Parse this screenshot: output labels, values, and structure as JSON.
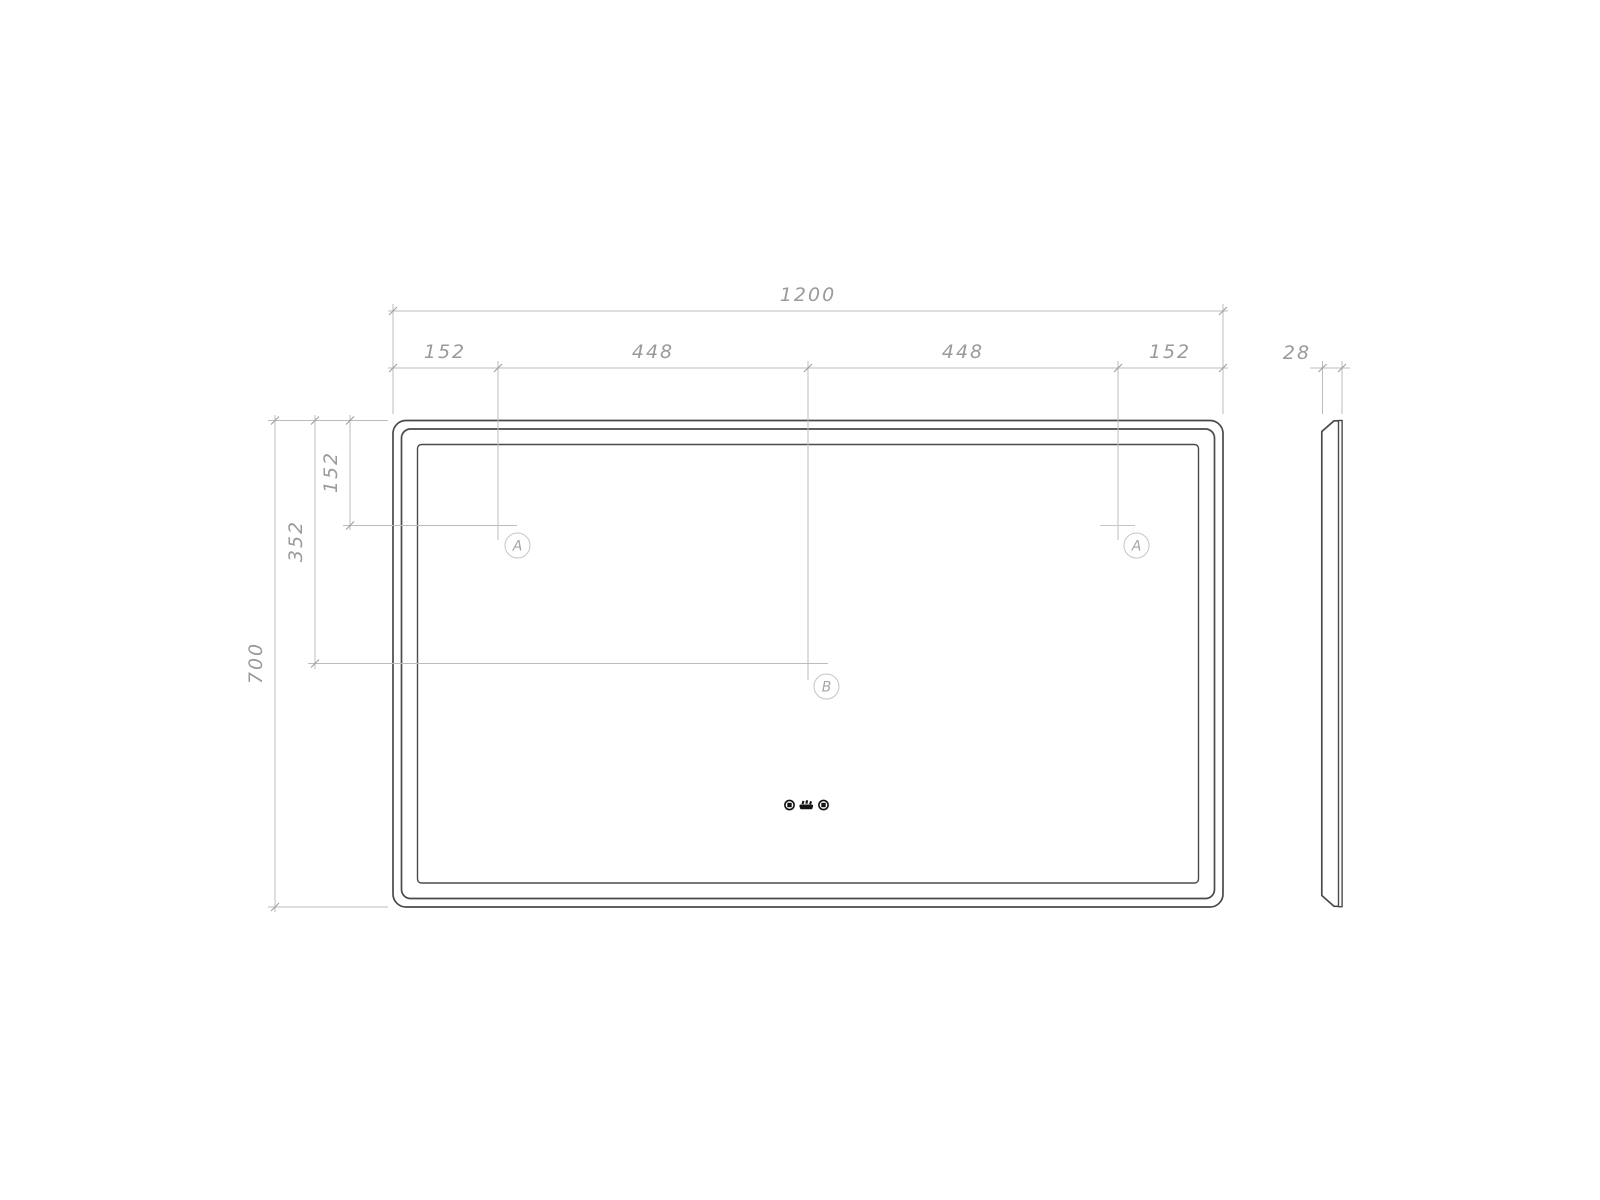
{
  "drawing": {
    "type": "technical-dimension-drawing",
    "subject": "rectangular LED mirror, front view and side profile",
    "colors": {
      "background": "#ffffff",
      "object_line": "#4a4a4a",
      "dimension_line": "#bcbcbc",
      "dimension_text": "#9a9a9a",
      "icon": "#141414"
    },
    "dimensions": {
      "top_total": "1200",
      "seg_left_margin": "152",
      "seg_left_half": "448",
      "seg_right_half": "448",
      "seg_right_margin": "152",
      "depth": "28",
      "height_total": "700",
      "b_offset": "352",
      "a_offset": "152"
    },
    "markers": {
      "a_left": "A",
      "a_right": "A",
      "b": "B"
    },
    "icons": [
      "touch-button",
      "anti-fog",
      "touch-button"
    ]
  }
}
